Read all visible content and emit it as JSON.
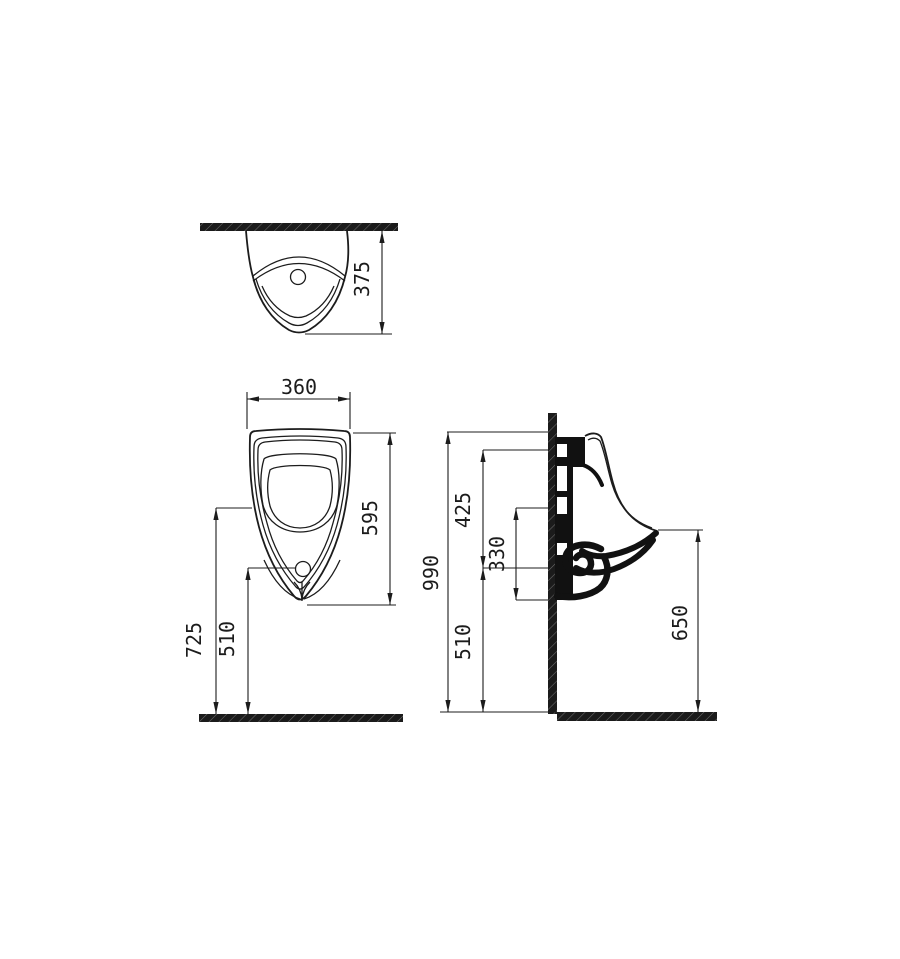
{
  "colors": {
    "background": "#ffffff",
    "line": "#1c1c1c",
    "text": "#1c1c1c"
  },
  "dims": {
    "top_depth": "375",
    "front_width": "360",
    "front_height": "595",
    "front_rim_height": "725",
    "front_drain_height": "510",
    "side_total_height": "990",
    "side_top_offset": "425",
    "side_mid_span": "330",
    "side_outlet_height": "510",
    "side_lip_height": "650"
  }
}
